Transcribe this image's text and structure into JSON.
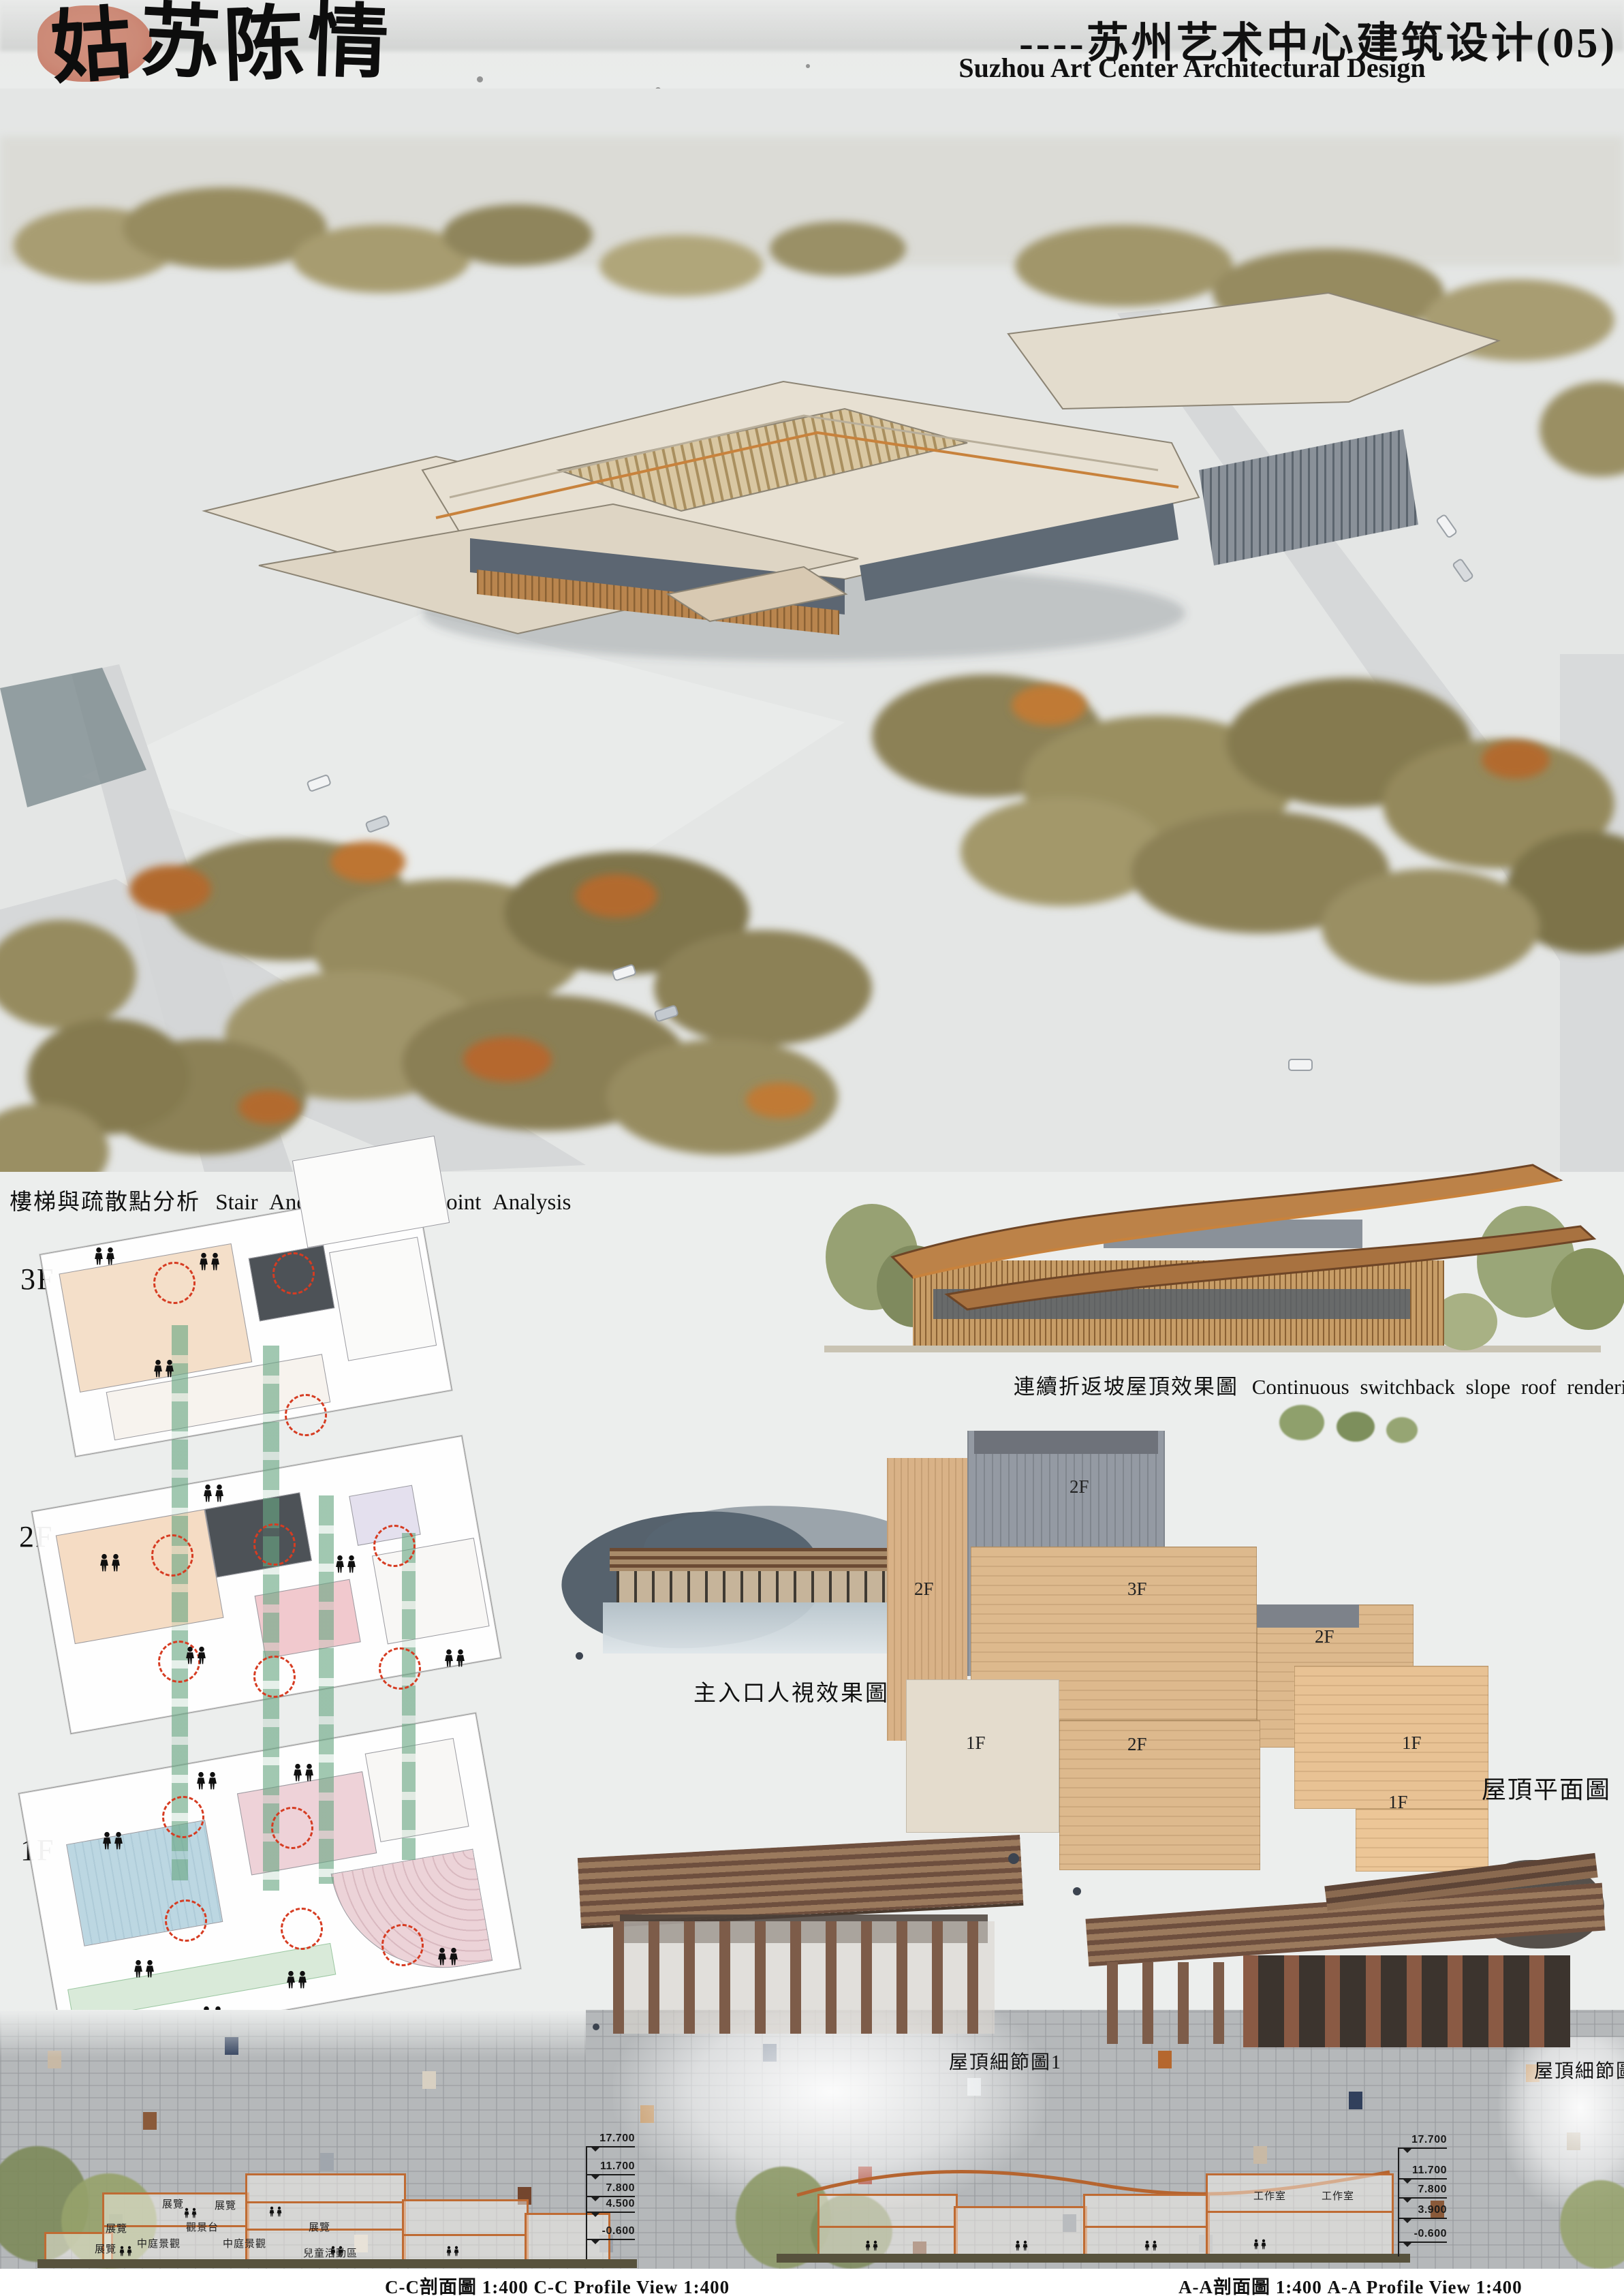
{
  "header": {
    "calligraphy": [
      "姑",
      "苏",
      "陈",
      "情"
    ],
    "subtitle_cn": "----苏州艺术中心建筑设计(05)",
    "subtitle_en": "Suzhou Art Center Architectural Design"
  },
  "analysis": {
    "title_cn": "樓梯與疏散點分析",
    "title_en": "Stair And Evacuation Point Analysis",
    "floors": [
      "3F",
      "2F",
      "1F"
    ]
  },
  "renderings": {
    "roof_caption_cn": "連續折返坡屋頂效果圖",
    "roof_caption_en": "Continuous switchback slope roof rendering",
    "entrance_caption": "主入口人視效果圖",
    "detail1_caption": "屋頂細節圖1",
    "detail2_caption": "屋頂細節圖2"
  },
  "roof_plan": {
    "caption": "屋頂平面圖",
    "labels": [
      "2F",
      "2F",
      "3F",
      "2F",
      "1F",
      "2F",
      "1F",
      "1F"
    ]
  },
  "sections": {
    "cc_caption": "C-C剖面圖  1:400  C-C Profile View  1:400",
    "aa_caption": "A-A剖面圖  1:400  A-A Profile View  1:400",
    "cc_elevations": [
      "17.700",
      "11.700",
      "7.800",
      "4.500",
      "-0.600"
    ],
    "aa_elevations": [
      "17.700",
      "11.700",
      "7.800",
      "3.900",
      "-0.600"
    ],
    "cc_rooms": [
      "展覽",
      "展覽",
      "展覽",
      "觀景台",
      "展覽",
      "中庭景觀",
      "中庭景觀",
      "展覽",
      "兒童活動區"
    ],
    "aa_rooms": [
      "工作室",
      "工作室"
    ]
  },
  "colors": {
    "sun_red": "#cc8a77",
    "evacuation_green": "#68a682",
    "evacuation_red": "#d63c22",
    "section_orange": "#bf6b33",
    "roof_tan": "#ddb98d"
  }
}
